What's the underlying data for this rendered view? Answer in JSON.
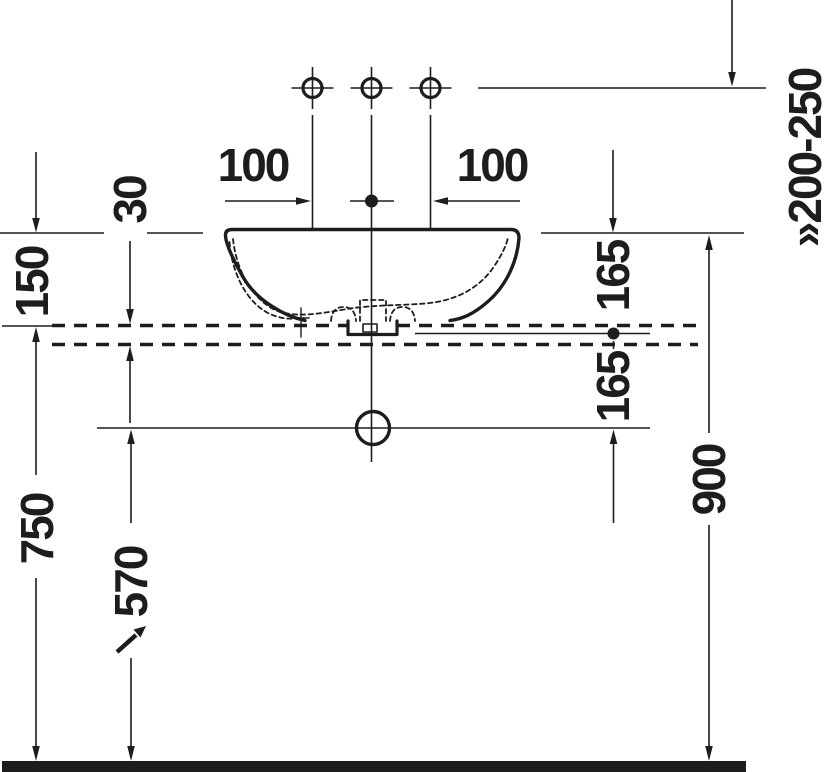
{
  "drawing": {
    "title": "washbasin-installation-side-elevation",
    "colors": {
      "line": "#1d1d1b",
      "background": "#ffffff"
    },
    "dimensions": {
      "faucet_offset_left": "100",
      "faucet_offset_right": "100",
      "counter_thickness": "30",
      "basin_above_counter": "150",
      "rim_to_counter_mid": "165",
      "counter_mid_to_outlet": "165",
      "counter_height": "750",
      "outlet_height": "570",
      "rim_height": "900",
      "faucet_height_range": "»200-250"
    }
  }
}
